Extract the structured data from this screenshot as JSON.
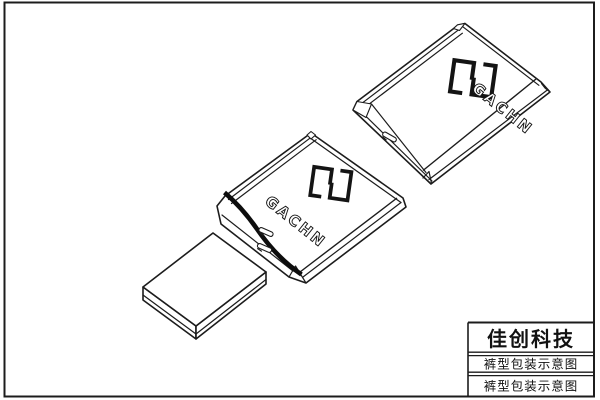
{
  "title_block": {
    "company": "佳创科技",
    "drawing_title": "裤型包装示意图",
    "drawing_title_2": "裤型包装示意图"
  },
  "packages": {
    "brand": "GACHN",
    "brand_2": "GACHN",
    "logo_icon": "gachn-meander-logo"
  },
  "colors": {
    "line": "#1c1c1c",
    "background": "#ffffff",
    "open_end_band": "#0d0d0d"
  }
}
